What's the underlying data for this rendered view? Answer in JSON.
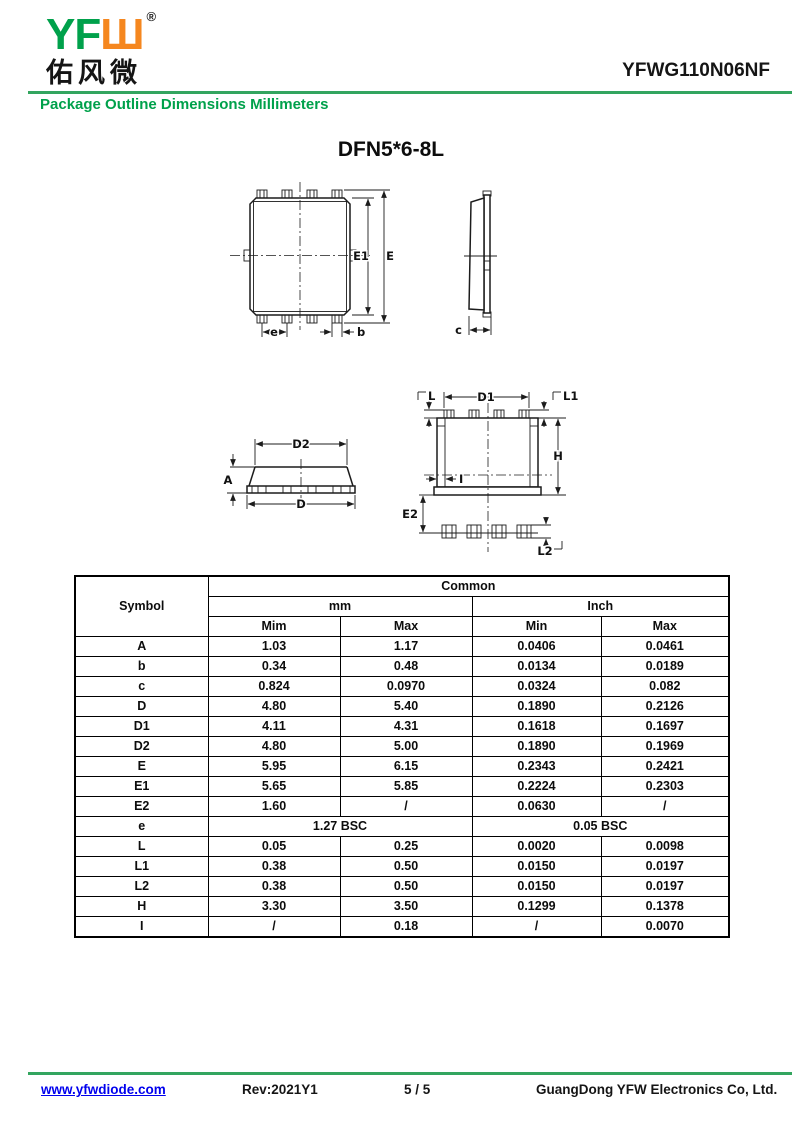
{
  "colors": {
    "green": "#00A14B",
    "orange": "#F5871F",
    "line_green": "#33A55F",
    "link_blue": "#0000EE",
    "ink": "#111111"
  },
  "header": {
    "logo_green": "YF",
    "logo_orange": "Ш",
    "registered": "®",
    "logo_chinese": "佑风微",
    "part_number": "YFWG110N06NF",
    "subtitle": "Package Outline Dimensions Millimeters"
  },
  "title": "DFN5*6-8L",
  "drawings": {
    "labels": {
      "E1": "E1",
      "E": "E",
      "e": "e",
      "b": "b",
      "c": "c",
      "D2": "D2",
      "A": "A",
      "D": "D",
      "D1": "D1",
      "L": "L",
      "L1": "L1",
      "H": "H",
      "E2": "E2",
      "L2": "L2",
      "I": "I"
    }
  },
  "table": {
    "header": {
      "symbol": "Symbol",
      "common": "Common",
      "mm": "mm",
      "inch": "Inch",
      "mm_min": "Mim",
      "mm_max": "Max",
      "inch_min": "Min",
      "inch_max": "Max"
    },
    "rows": [
      {
        "symbol": "A",
        "mm_min": "1.03",
        "mm_max": "1.17",
        "inch_min": "0.0406",
        "inch_max": "0.0461"
      },
      {
        "symbol": "b",
        "mm_min": "0.34",
        "mm_max": "0.48",
        "inch_min": "0.0134",
        "inch_max": "0.0189"
      },
      {
        "symbol": "c",
        "mm_min": "0.824",
        "mm_max": "0.0970",
        "inch_min": "0.0324",
        "inch_max": "0.082"
      },
      {
        "symbol": "D",
        "mm_min": "4.80",
        "mm_max": "5.40",
        "inch_min": "0.1890",
        "inch_max": "0.2126"
      },
      {
        "symbol": "D1",
        "mm_min": "4.11",
        "mm_max": "4.31",
        "inch_min": "0.1618",
        "inch_max": "0.1697"
      },
      {
        "symbol": "D2",
        "mm_min": "4.80",
        "mm_max": "5.00",
        "inch_min": "0.1890",
        "inch_max": "0.1969"
      },
      {
        "symbol": "E",
        "mm_min": "5.95",
        "mm_max": "6.15",
        "inch_min": "0.2343",
        "inch_max": "0.2421"
      },
      {
        "symbol": "E1",
        "mm_min": "5.65",
        "mm_max": "5.85",
        "inch_min": "0.2224",
        "inch_max": "0.2303"
      },
      {
        "symbol": "E2",
        "mm_min": "1.60",
        "mm_max": "/",
        "inch_min": "0.0630",
        "inch_max": "/"
      },
      {
        "symbol": "e",
        "mm_span": "1.27 BSC",
        "inch_span": "0.05 BSC"
      },
      {
        "symbol": "L",
        "mm_min": "0.05",
        "mm_max": "0.25",
        "inch_min": "0.0020",
        "inch_max": "0.0098"
      },
      {
        "symbol": "L1",
        "mm_min": "0.38",
        "mm_max": "0.50",
        "inch_min": "0.0150",
        "inch_max": "0.0197"
      },
      {
        "symbol": "L2",
        "mm_min": "0.38",
        "mm_max": "0.50",
        "inch_min": "0.0150",
        "inch_max": "0.0197"
      },
      {
        "symbol": "H",
        "mm_min": "3.30",
        "mm_max": "3.50",
        "inch_min": "0.1299",
        "inch_max": "0.1378"
      },
      {
        "symbol": "I",
        "mm_min": "/",
        "mm_max": "0.18",
        "inch_min": "/",
        "inch_max": "0.0070"
      }
    ]
  },
  "footer": {
    "website": "www.yfwdiode.com",
    "revision": "Rev:2021Y1",
    "page": "5 / 5",
    "company": "GuangDong YFW Electronics Co, Ltd."
  }
}
